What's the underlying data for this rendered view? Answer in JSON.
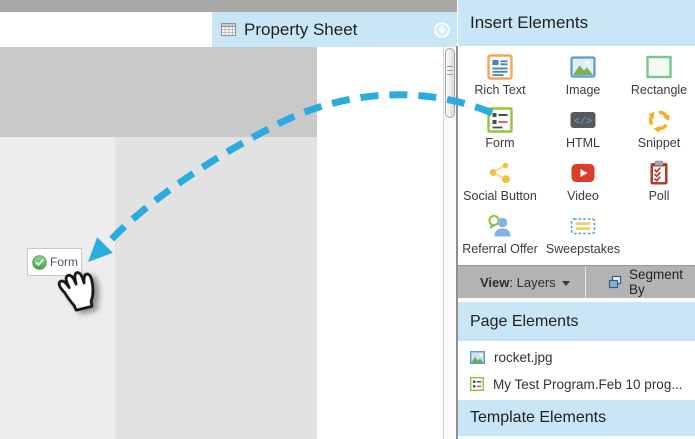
{
  "colors": {
    "header_blue": "#c9e6f7",
    "arrow_blue": "#2bacdf",
    "view_bar_gray": "#b3b3b3",
    "top_bar_gray": "#a8a8a8",
    "hero_gray": "#c9c9c9",
    "canvas_light": "#ededed",
    "canvas_mid": "#e2e2e2",
    "accent_green": "#8dc63f",
    "icon_orange": "#f1a75d",
    "icon_blue": "#5b9bd5",
    "icon_yellow": "#f0b42f",
    "icon_red": "#dc3c2a"
  },
  "property_sheet": {
    "title": "Property Sheet",
    "title_icon": "table-grid-icon",
    "collapse_icon": "download-circle-icon"
  },
  "canvas": {
    "form_chip": {
      "label": "Form",
      "icon": "check-circle-icon"
    },
    "drag_hint_icon": "dashed-curved-arrow",
    "cursor_icon": "hand-grab-cursor"
  },
  "insert_elements": {
    "title": "Insert Elements",
    "items": [
      {
        "label": "Rich Text",
        "icon": "rich-text-icon"
      },
      {
        "label": "Image",
        "icon": "image-icon"
      },
      {
        "label": "Rectangle",
        "icon": "rectangle-icon"
      },
      {
        "label": "Form",
        "icon": "form-icon",
        "": ""
      },
      {
        "label": "HTML",
        "icon": "html-icon",
        "icon_text": "</>"
      },
      {
        "label": "Snippet",
        "icon": "snippet-icon"
      },
      {
        "label": "Social Button",
        "icon": "social-button-icon"
      },
      {
        "label": "Video",
        "icon": "video-icon"
      },
      {
        "label": "Poll",
        "icon": "poll-icon"
      },
      {
        "label": "Referral Offer",
        "icon": "referral-offer-icon"
      },
      {
        "label": "Sweepstakes",
        "icon": "sweepstakes-icon"
      }
    ]
  },
  "view_bar": {
    "view_label": "View",
    "separator": ": ",
    "view_value": "Layers",
    "segment_by_label": "Segment By",
    "segment_icon": "cascade-windows-icon"
  },
  "page_elements": {
    "title": "Page Elements",
    "items": [
      {
        "label": "rocket.jpg",
        "icon": "image-file-icon"
      },
      {
        "label": "My Test Program.Feb 10 prog...",
        "icon": "form-file-icon"
      }
    ]
  },
  "template_elements": {
    "title": "Template Elements"
  }
}
